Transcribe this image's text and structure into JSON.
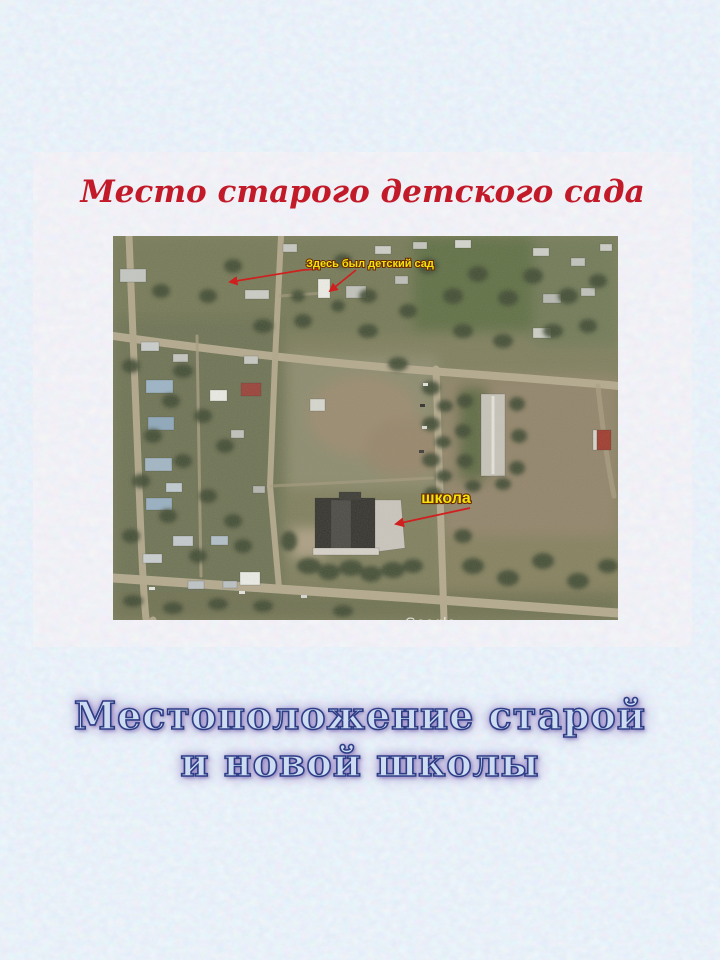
{
  "slide": {
    "title": "Место старого детского сада",
    "caption": {
      "line1": "Местоположение старой",
      "line2": "и новой школы"
    }
  },
  "map": {
    "labels": {
      "kindergarten": "Здесь был детский сад",
      "school": "школа"
    },
    "watermark": "Google",
    "colors": {
      "annotation_text": "#f2e40a",
      "arrow": "#d01f1f"
    }
  },
  "colors": {
    "page_background": "#d6e4f3",
    "panel_background": "#eef0f5",
    "title_red": "#c21a28",
    "caption_fill": "#cddcf0",
    "caption_outline": "#2d3d86",
    "caption_glow": "#9a8ac6"
  }
}
